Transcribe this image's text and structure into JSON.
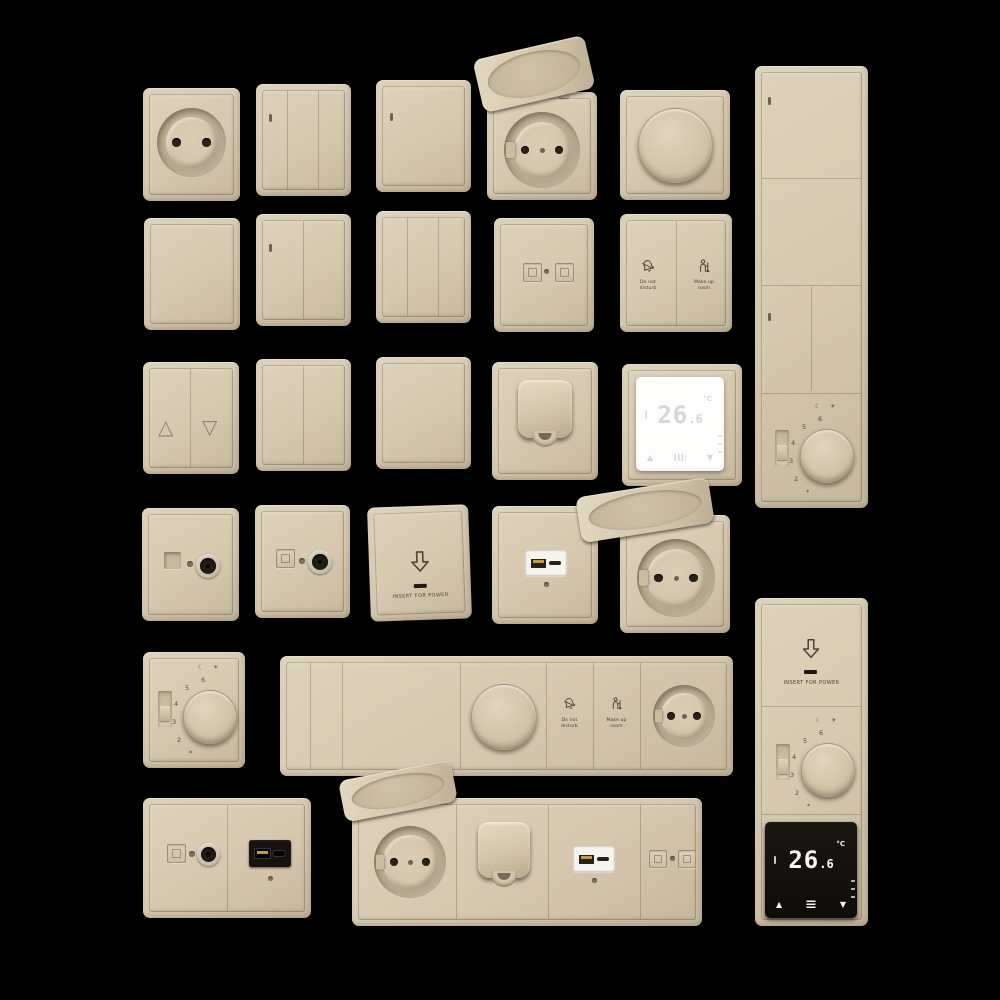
{
  "scene": {
    "description": "3D render catalog of beige wall switches, sockets, dimmers and thermostats on black background",
    "plate_color": "#d6c9af",
    "background_color": "#000000",
    "accent_dark": "#4e4335"
  },
  "texts": {
    "do_not_disturb_1": "Do not",
    "do_not_disturb_2": "disturb",
    "make_up_room_1": "Make up",
    "make_up_room_2": "room",
    "insert_for_power": "INSERT FOR POWER"
  },
  "dial": {
    "n6": "6",
    "n5": "5",
    "n4": "4",
    "n3": "3",
    "n2": "2",
    "moon": "☾",
    "sun": "☀",
    "frost": "*"
  },
  "thermo": {
    "value_int": "26",
    "value_dec": ".6",
    "unit": "°C",
    "up": "▲",
    "down": "▼"
  },
  "blinds": {
    "up": "△",
    "down": "▽"
  },
  "icons": [
    "bell-slash-icon",
    "housekeeper-icon",
    "arrow-down-icon",
    "moon-icon",
    "sun-icon",
    "frost-icon",
    "heat-grill-icon",
    "menu-icon"
  ]
}
